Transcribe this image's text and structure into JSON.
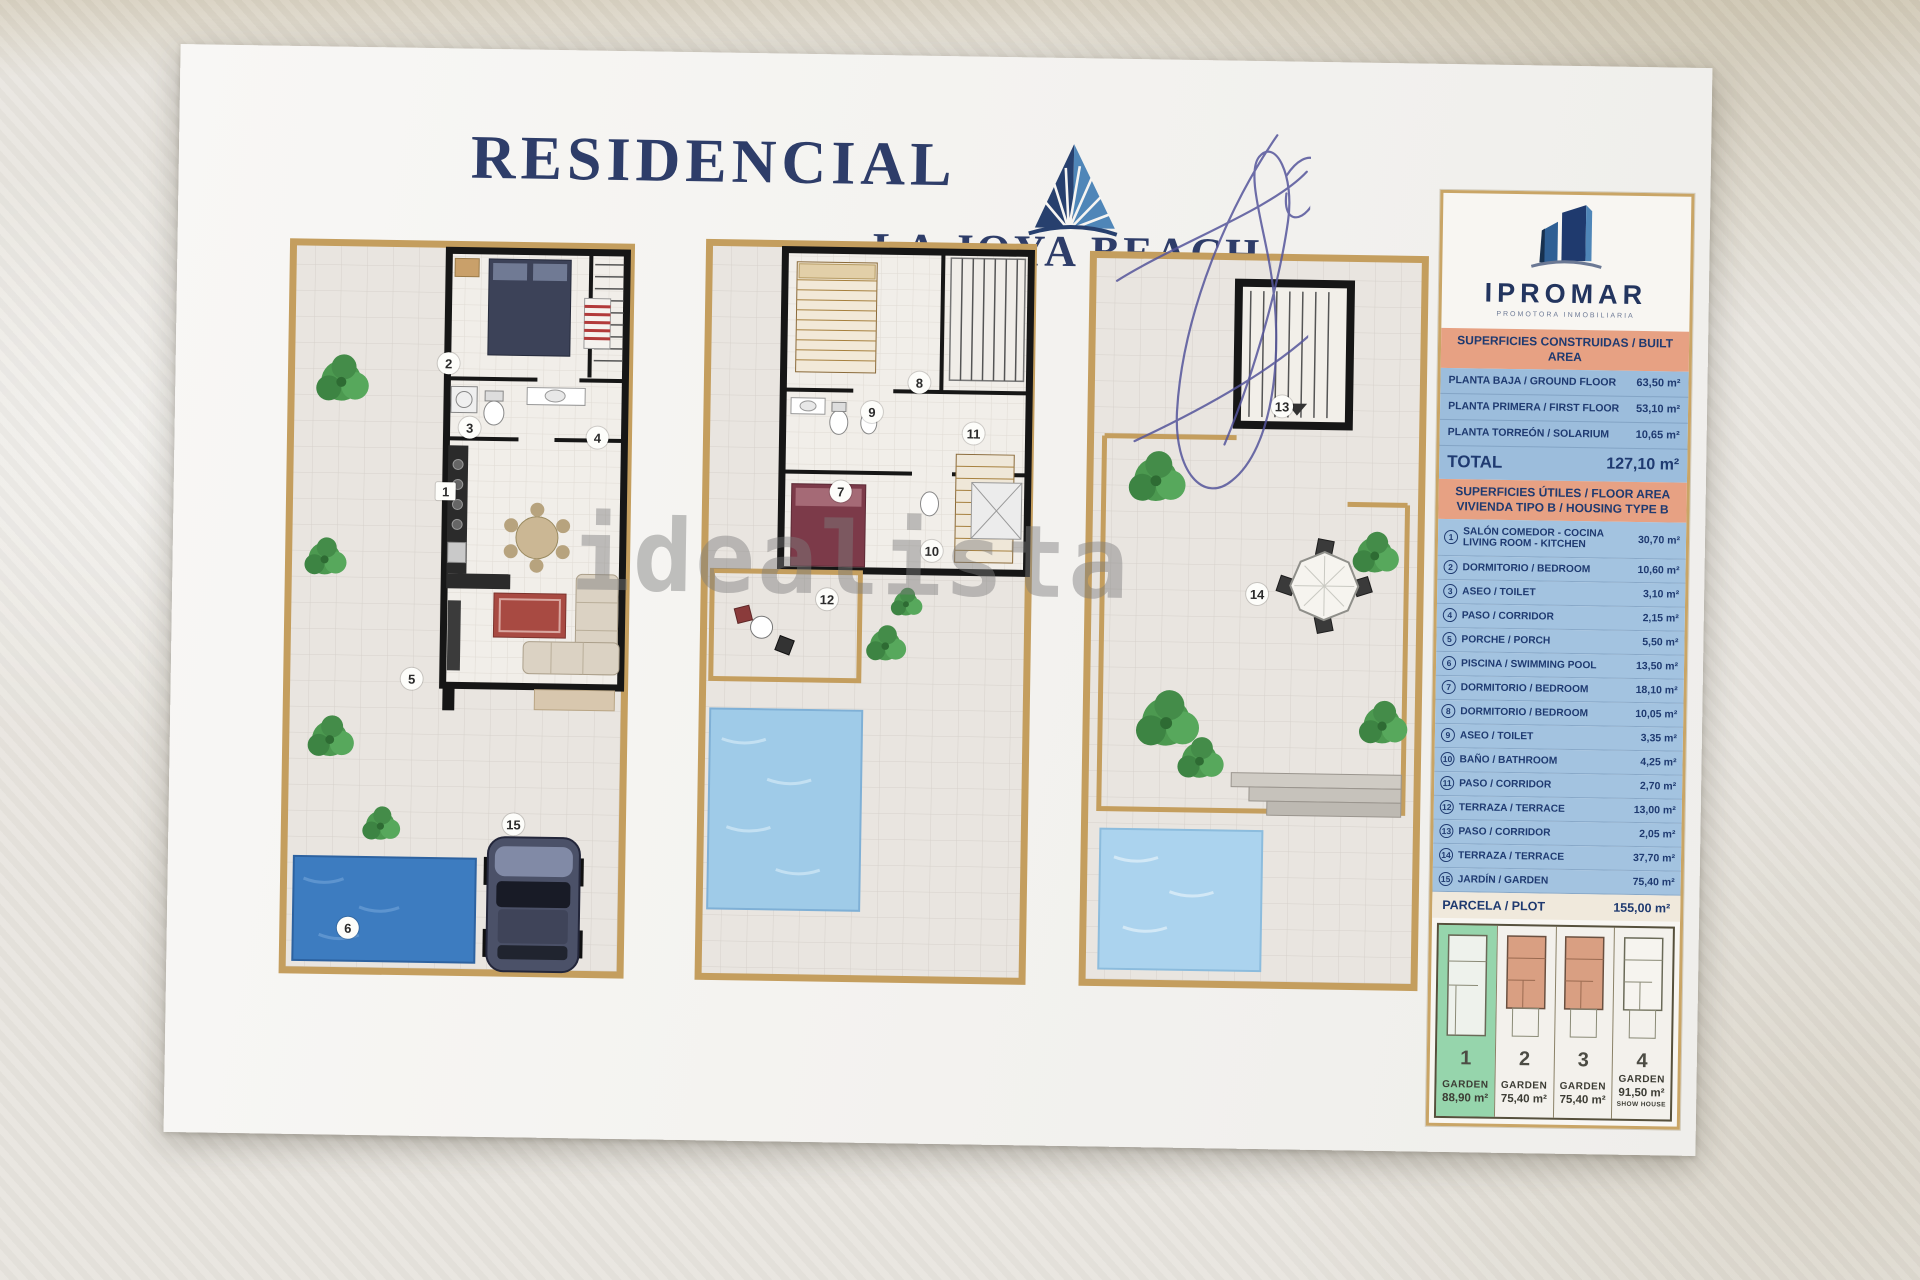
{
  "title": {
    "line1": "RESIDENCIAL",
    "line2": "LA JOYA BEACH"
  },
  "watermark": "idealista",
  "brand": {
    "name": "IPROMAR",
    "tagline": "PROMOTORA INMOBILIARIA"
  },
  "built_area": {
    "header": "SUPERFICIES CONSTRUIDAS / BUILT AREA",
    "rows": [
      {
        "label": "PLANTA BAJA / GROUND FLOOR",
        "value": "63,50 m²"
      },
      {
        "label": "PLANTA PRIMERA / FIRST FLOOR",
        "value": "53,10 m²"
      },
      {
        "label": "PLANTA TORREÓN / SOLARIUM",
        "value": "10,65 m²"
      }
    ],
    "total_label": "TOTAL",
    "total_value": "127,10 m²"
  },
  "floor_area": {
    "header_line1": "SUPERFICIES ÚTILES / FLOOR AREA",
    "header_line2": "VIVIENDA TIPO B / HOUSING TYPE B",
    "items": [
      {
        "num": "1",
        "label": "SALÓN COMEDOR - COCINA\nLIVING ROOM - KITCHEN",
        "value": "30,70 m²"
      },
      {
        "num": "2",
        "label": "DORMITORIO / BEDROOM",
        "value": "10,60 m²"
      },
      {
        "num": "3",
        "label": "ASEO / TOILET",
        "value": "3,10 m²"
      },
      {
        "num": "4",
        "label": "PASO / CORRIDOR",
        "value": "2,15 m²"
      },
      {
        "num": "5",
        "label": "PORCHE / PORCH",
        "value": "5,50 m²"
      },
      {
        "num": "6",
        "label": "PISCINA / SWIMMING POOL",
        "value": "13,50 m²"
      },
      {
        "num": "7",
        "label": "DORMITORIO / BEDROOM",
        "value": "18,10 m²"
      },
      {
        "num": "8",
        "label": "DORMITORIO / BEDROOM",
        "value": "10,05 m²"
      },
      {
        "num": "9",
        "label": "ASEO / TOILET",
        "value": "3,35 m²"
      },
      {
        "num": "10",
        "label": "BAÑO / BATHROOM",
        "value": "4,25 m²"
      },
      {
        "num": "11",
        "label": "PASO / CORRIDOR",
        "value": "2,70 m²"
      },
      {
        "num": "12",
        "label": "TERRAZA / TERRACE",
        "value": "13,00 m²"
      },
      {
        "num": "13",
        "label": "PASO / CORRIDOR",
        "value": "2,05 m²"
      },
      {
        "num": "14",
        "label": "TERRAZA / TERRACE",
        "value": "37,70 m²"
      },
      {
        "num": "15",
        "label": "JARDÍN / GARDEN",
        "value": "75,40 m²"
      }
    ]
  },
  "plot": {
    "label": "PARCELA / PLOT",
    "value": "155,00 m²"
  },
  "site_plan": {
    "plots": [
      {
        "num": "1",
        "label": "GARDEN",
        "area": "88,90 m²",
        "note": ""
      },
      {
        "num": "2",
        "label": "GARDEN",
        "area": "75,40 m²",
        "note": ""
      },
      {
        "num": "3",
        "label": "GARDEN",
        "area": "75,40 m²",
        "note": ""
      },
      {
        "num": "4",
        "label": "GARDEN",
        "area": "91,50 m²",
        "note": "SHOW HOUSE"
      }
    ]
  },
  "plan_labels": {
    "ground": {
      "living": "1",
      "bedroom": "2",
      "toilet": "3",
      "corridor": "4",
      "porch": "5",
      "pool": "6",
      "garden": "15"
    },
    "first": {
      "bedroom_main": "7",
      "bedroom_top": "8",
      "toilet": "9",
      "bathroom": "10",
      "stairs": "11",
      "terrace": "12"
    },
    "solarium": {
      "corridor": "13",
      "terrace": "14"
    }
  },
  "colors": {
    "navy": "#2e3d69",
    "salmon": "#e7a183",
    "table_blue": "#9cbddc",
    "tan_frame": "#c49e5e",
    "pool_ground": "#3d7cc0",
    "pool_first": "#9fcbe8",
    "pool_solarium": "#abd3ee",
    "highlight_green": "#48be78"
  }
}
